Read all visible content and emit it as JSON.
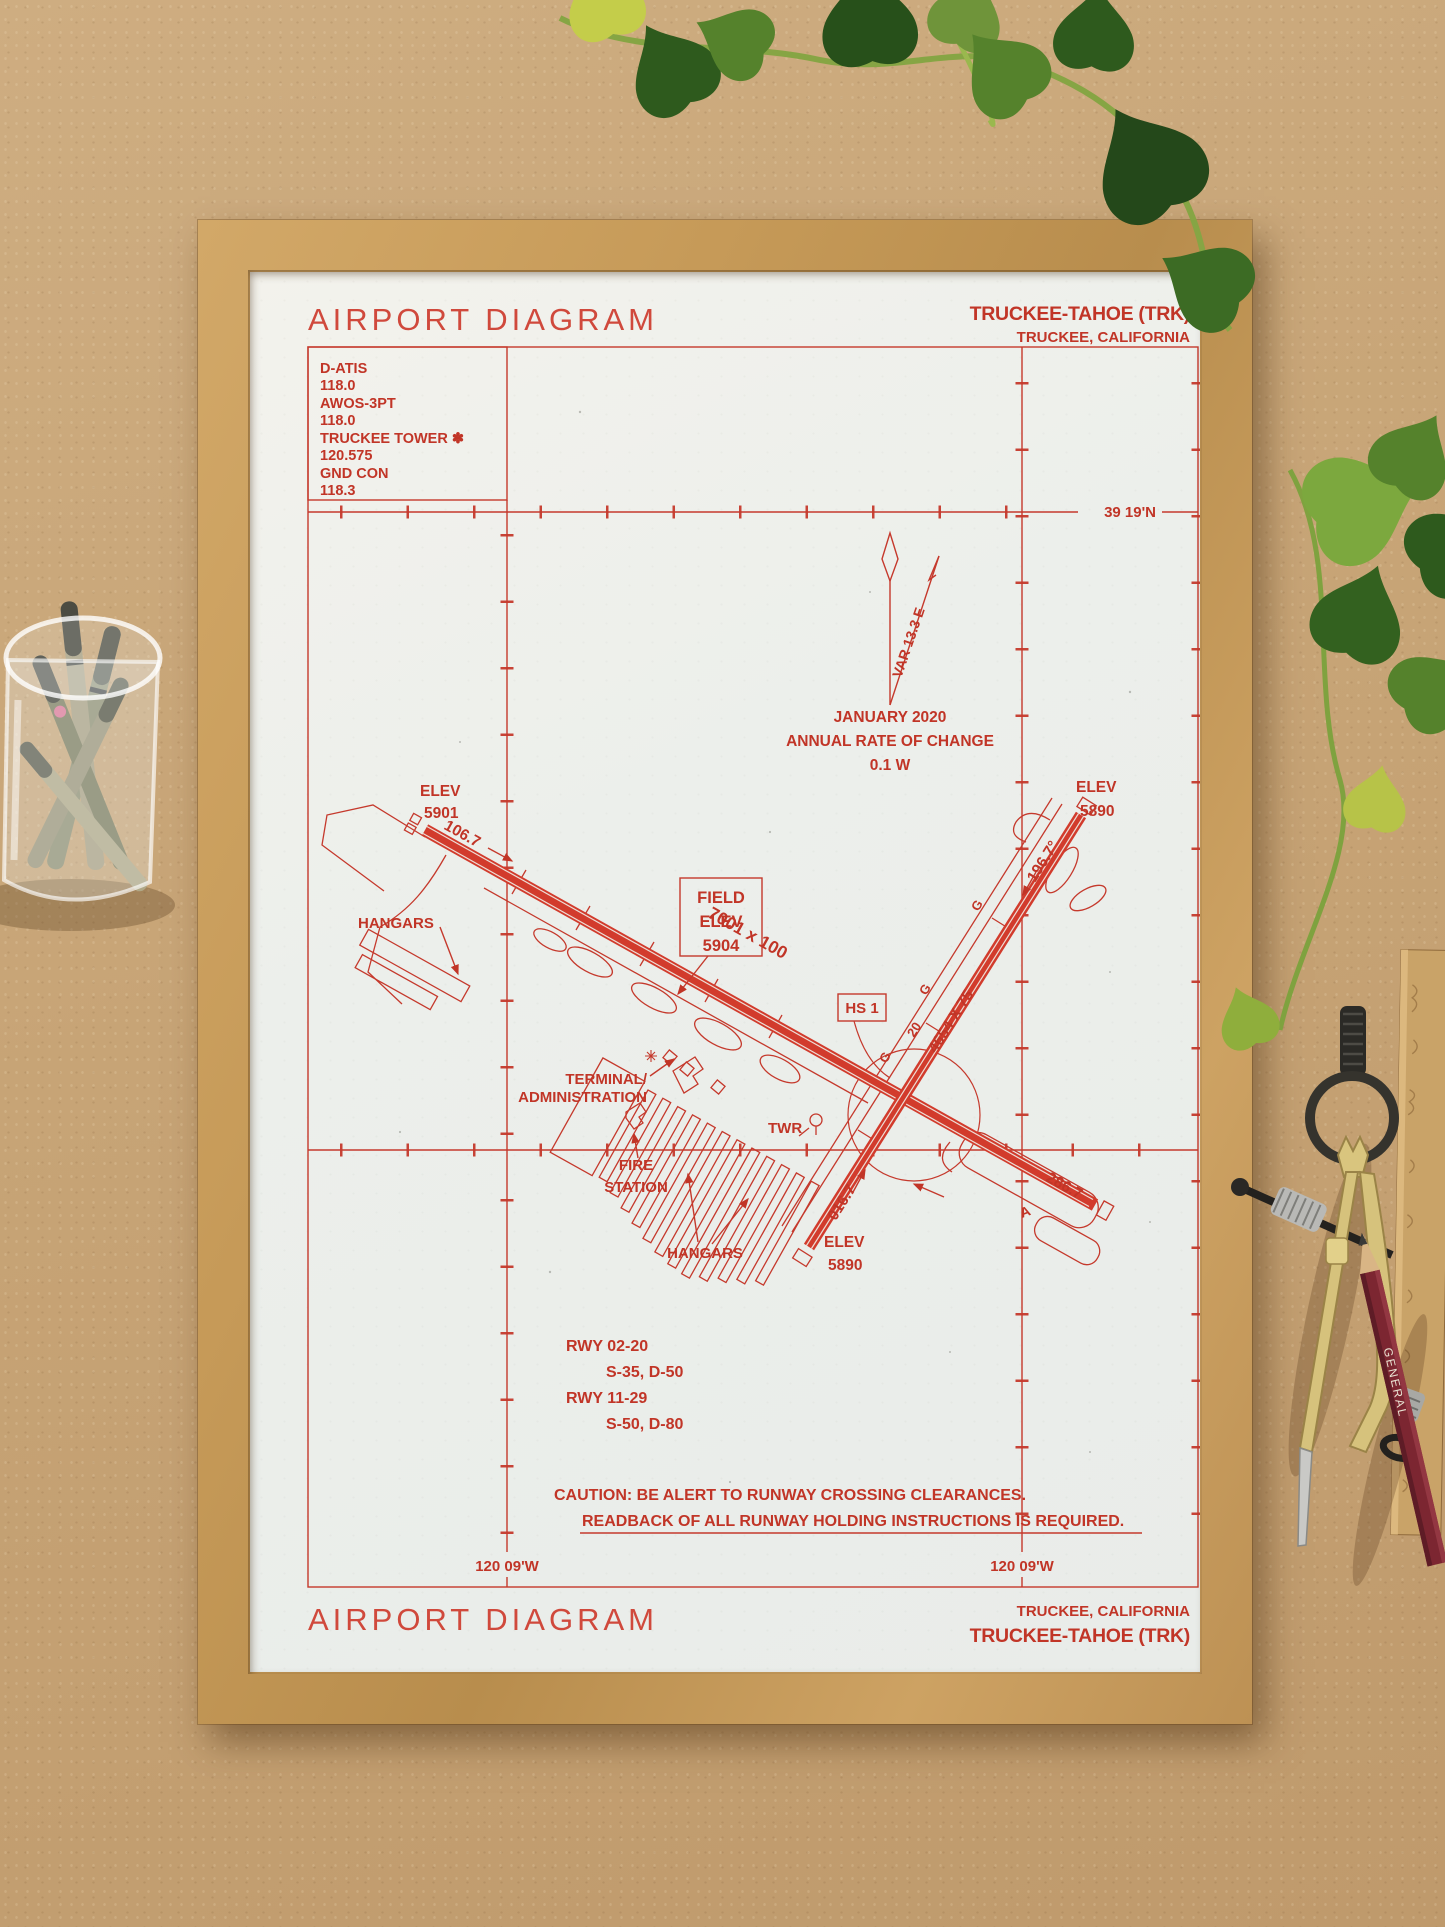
{
  "scene": {
    "desk_color": "#c7a476",
    "frame_color": "#c69a58",
    "paper_color": "#f0efe9",
    "ink_color": "#c5392c"
  },
  "header": {
    "title": "AIRPORT DIAGRAM",
    "airport_name": "TRUCKEE-TAHOE (TRK)",
    "airport_location": "TRUCKEE, CALIFORNIA"
  },
  "comm_box": {
    "lines": [
      "D-ATIS",
      "118.0",
      "AWOS-3PT",
      "118.0",
      "TRUCKEE TOWER ✽",
      "120.575",
      "GND CON",
      "118.3"
    ]
  },
  "diagram": {
    "lat_label": "39 19'N",
    "lon_label_left": "120 09'W",
    "lon_label_right": "120 09'W",
    "variation": "VAR 13.3  E",
    "change_date": "JANUARY 2020",
    "change_label": "ANNUAL RATE OF CHANGE",
    "change_value": "0.1  W",
    "rwy_11_29_size": "7001 x 100",
    "rwy_02_20_size": "4654 X 75",
    "hdg_11": "106.7",
    "hdg_29": "286.7",
    "hdg_02": "016.7",
    "hdg_20": "196.7°",
    "elev_rwy11": [
      "ELEV",
      "5901"
    ],
    "elev_rwy20": [
      "ELEV",
      "5890"
    ],
    "elev_rwy02": [
      "ELEV",
      "5890"
    ],
    "field_elev": [
      "FIELD",
      "ELEV",
      "5904"
    ],
    "hot_spot": "HS 1",
    "tower": "TWR",
    "terminal": [
      "TERMINAL/",
      "ADMINISTRATION"
    ],
    "fire_station": [
      "FIRE",
      "STATION"
    ],
    "hangars_west": "HANGARS",
    "hangars_south": "HANGARS",
    "taxiway_g": "G",
    "taxiway_a": "A",
    "hold_20": "20"
  },
  "runway_data": {
    "lines": [
      "RWY 02-20",
      "S-35, D-50",
      "RWY 11-29",
      "S-50, D-80"
    ]
  },
  "caution": {
    "line1": "CAUTION: BE ALERT TO RUNWAY CROSSING CLEARANCES.",
    "line2": "READBACK OF ALL RUNWAY HOLDING INSTRUCTIONS IS REQUIRED."
  },
  "footer": {
    "title": "AIRPORT DIAGRAM",
    "airport_location": "TRUCKEE, CALIFORNIA",
    "airport_name": "TRUCKEE-TAHOE (TRK)"
  },
  "props": {
    "pencil_brand": "GENERAL"
  }
}
